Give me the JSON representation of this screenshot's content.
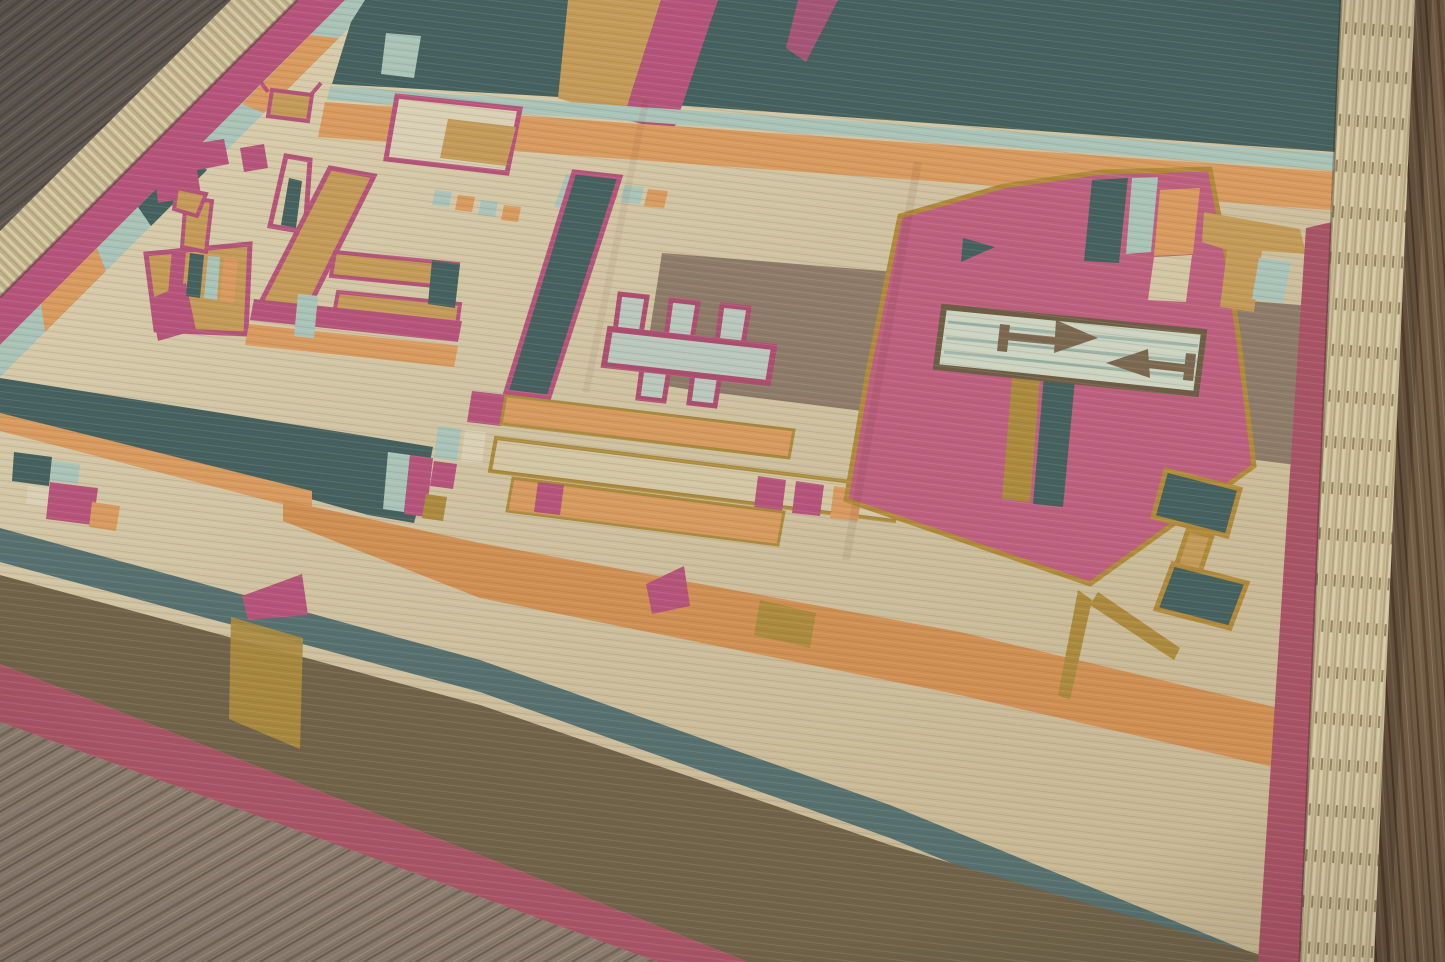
{
  "scene": {
    "subject": "Handwoven flat-weave kilim dhurrie rug with geometric Art-Deco motifs",
    "description": "Angled photograph of a large handwoven flat-weave wool dhurrie rug with beige field and geometric motifs in rose, teal, orange, gold and taupe, laid diagonally on a brown wood plank floor; knotted cream fringe runs along two edges",
    "setting": "wood plank floor",
    "view": "oblique perspective from above, rug rotated diagonally in frame",
    "lighting": "even indoor light, slight vignette"
  },
  "floor": {
    "material": "hardwood planks",
    "zones": [
      "dark gray-brown upper-left",
      "warm brown right strip",
      "lighter mauve-gray lower-left"
    ]
  },
  "rug": {
    "construction": "flat-weave, visible weft striations",
    "fringe": "knotted cream tassels on upper-left end and right end",
    "motifs": [
      "dark teal header band with gold wedge and pink diagonals",
      "pale aqua pinstripe and apricot band",
      "taupe cross band",
      "pavilion with flag and teal pennant",
      "peacock figure with striped tail ladder",
      "stacked color tabs",
      "stepped zigzag chips",
      "teal pillar with pink trim",
      "H-shaped comb medallion",
      "triple ladder rows with color tabs",
      "large rose panel with gold outline and kite tail",
      "arrow banner with double-headed brown arrows",
      "teal double-arrowhead drop",
      "gold hook bird head",
      "long apricot stripe, teal stripe, olive-brown band, rose edge border"
    ]
  },
  "palette": {
    "cream_field": "#cfc2a1",
    "cream_light": "#d9cdae",
    "ivory": "#d9cfb4",
    "teal_dark": "#44605e",
    "teal_soft": "#55706e",
    "aqua_pale": "#a9c3b8",
    "orange_band": "#d89a5e",
    "orange_deep": "#cf8f52",
    "gold_tan": "#c49a58",
    "gold_dark": "#ab8a3e",
    "rose_panel": "#bd5f7f",
    "rose_trim": "#b5537a",
    "rose_edge": "#a85365",
    "taupe_band": "#8d7b69",
    "brown_band": "#6f6249",
    "banner_pale": "#ccd3c1",
    "banner_line": "#9db4a8",
    "arrow_brown": "#7b6750",
    "outline_brown": "#6e5d45",
    "fringe": "#cdc09d",
    "wood_dark": "#5f574f",
    "wood_warm": "#715c46",
    "wood_pale": "#8b7c6f",
    "shadow": "#3a3128"
  }
}
